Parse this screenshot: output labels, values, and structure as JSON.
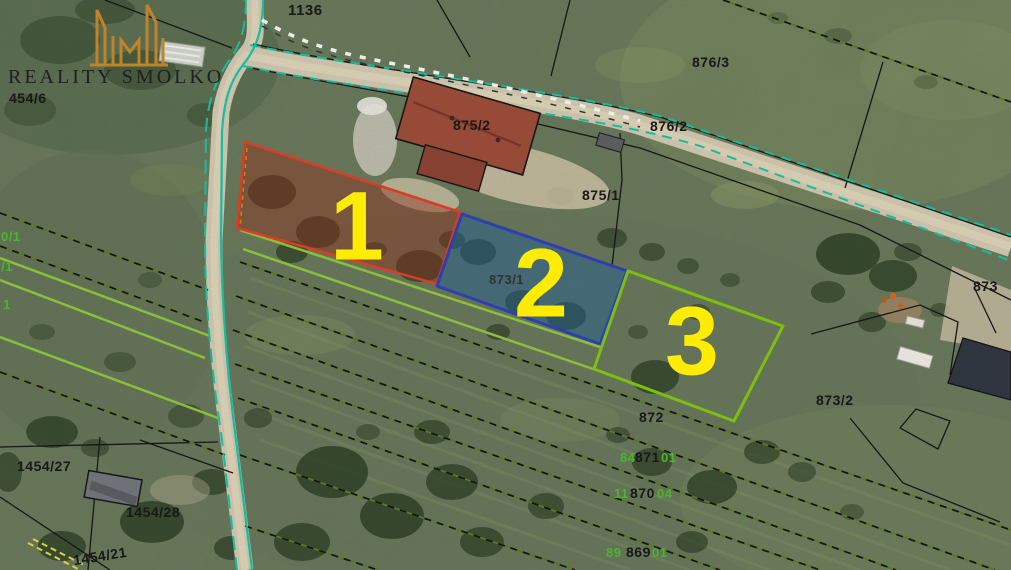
{
  "logo": {
    "brand": "REALITY SMOLKO",
    "icon": "buildings-skyline-icon"
  },
  "plot_markers": {
    "plot1": "1",
    "plot2": "2",
    "plot3": "3"
  },
  "labels": {
    "p1136": "1136",
    "p454_6": "454/6",
    "p876_3": "876/3",
    "p876_2": "876/2",
    "p875_2": "875/2",
    "p875_1": "875/1",
    "p873_1": "873/1",
    "p873_2": "873/2",
    "p873_right": "873",
    "p872": "872",
    "p871": "871",
    "p870": "870",
    "p869": "869",
    "p1454_27": "1454/27",
    "p1454_28": "1454/28",
    "p1454_21": "1454/21",
    "g_left_top": "0/1",
    "g_left_mid": "/1",
    "g_left_low": "1",
    "g871_before": "84",
    "g871_after": "01",
    "g870_before": "11",
    "g870_after": "04",
    "g869_before": "89",
    "g869_after": "01"
  },
  "colors": {
    "plot1_stroke": "#e23b25",
    "plot1_fill": "rgba(150,40,25,0.42)",
    "plot2_stroke": "#2e3eb5",
    "plot2_fill": "rgba(35,95,150,0.5)",
    "plot3_stroke": "#80c40e",
    "plot3_fill": "none",
    "plot_number_yellow": "#ffec00",
    "cadastral_black": "#141414",
    "utility_teal": "#14c2a4",
    "field_green_line": "#8fc43c",
    "label_black": "#181818",
    "label_green": "#4bb52f",
    "logo_orange": "#bf8428",
    "road_tan": "#cfc6ae",
    "roof_red": "#9a4a37"
  }
}
